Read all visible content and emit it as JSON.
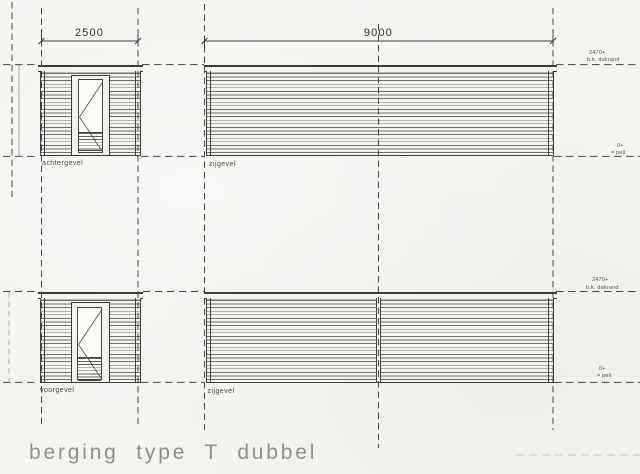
{
  "title": "berging type T dubbel",
  "dimensions": {
    "left": "2500",
    "right": "9000"
  },
  "elevation_labels": {
    "rear": "achtergevel",
    "side_top": "zijgevel",
    "front": "voorgevel",
    "side_bottom": "zijgevel"
  },
  "level_marks": {
    "roof": {
      "value": "2470+",
      "label": "b.k. dakrand"
    },
    "ground": {
      "value": "0+",
      "label": "= peil"
    }
  },
  "colors": {
    "paper": "#f5f4f1",
    "ink": "#3b3b39",
    "grid_ink": "#474742",
    "title_ink": "#8f8f8b"
  }
}
